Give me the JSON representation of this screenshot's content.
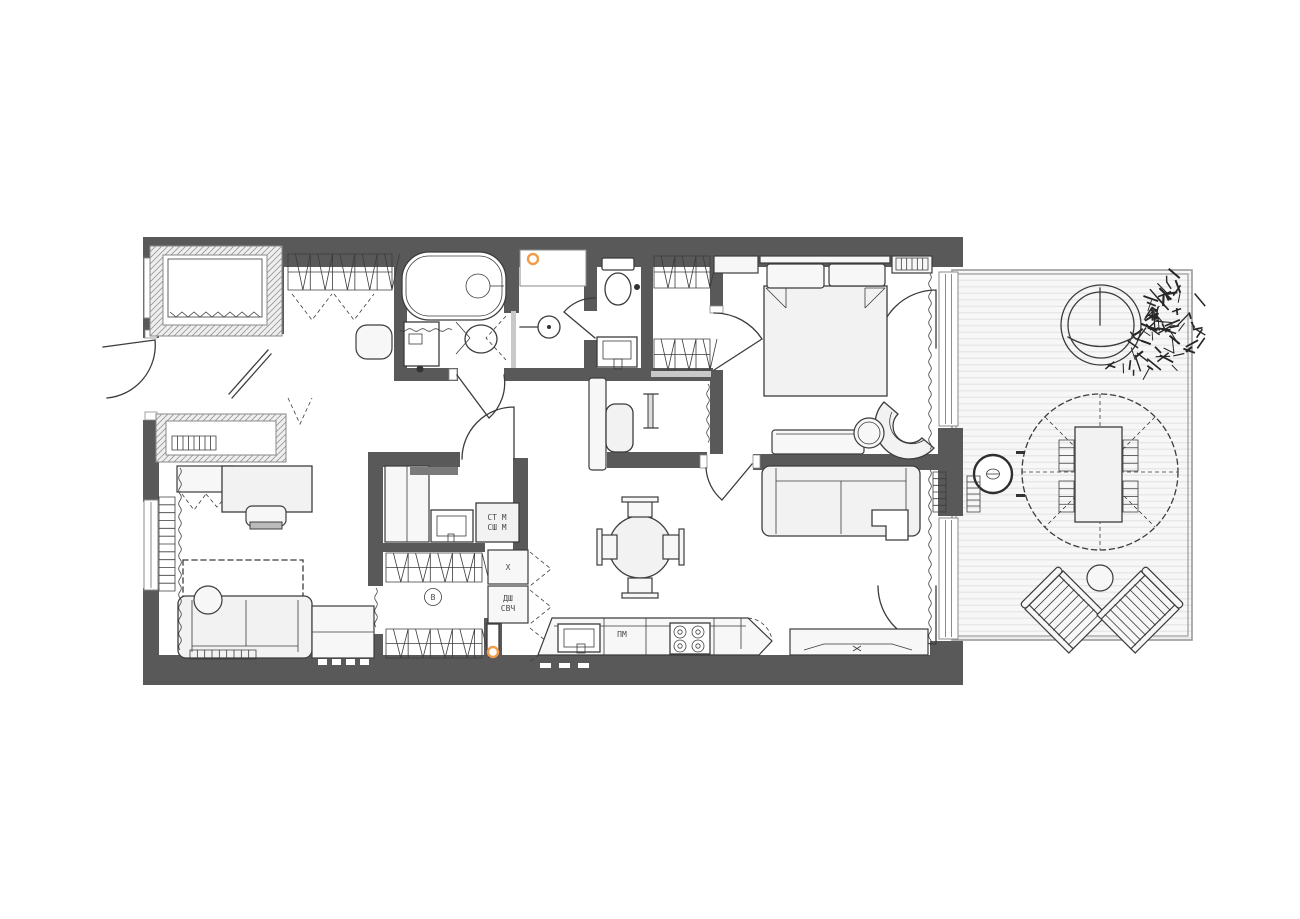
{
  "plan": {
    "labels": {
      "washer": "СТ М",
      "dryer": "СШ М",
      "fridge": "Х",
      "oven": "ДШ",
      "microwave": "СВЧ",
      "dishwasher": "ПМ",
      "vent": "В"
    },
    "colors": {
      "wall": "#595959",
      "line": "#3c3c3c",
      "furniture_fill": "#f2f2f2",
      "deck_stripe": "#e5e5e5",
      "deck_fill": "#f7f7f7",
      "accent": "#f09d49",
      "light_partition": "#c9c9c9",
      "label_text": "#4a4a4a",
      "background": "#ffffff"
    }
  }
}
